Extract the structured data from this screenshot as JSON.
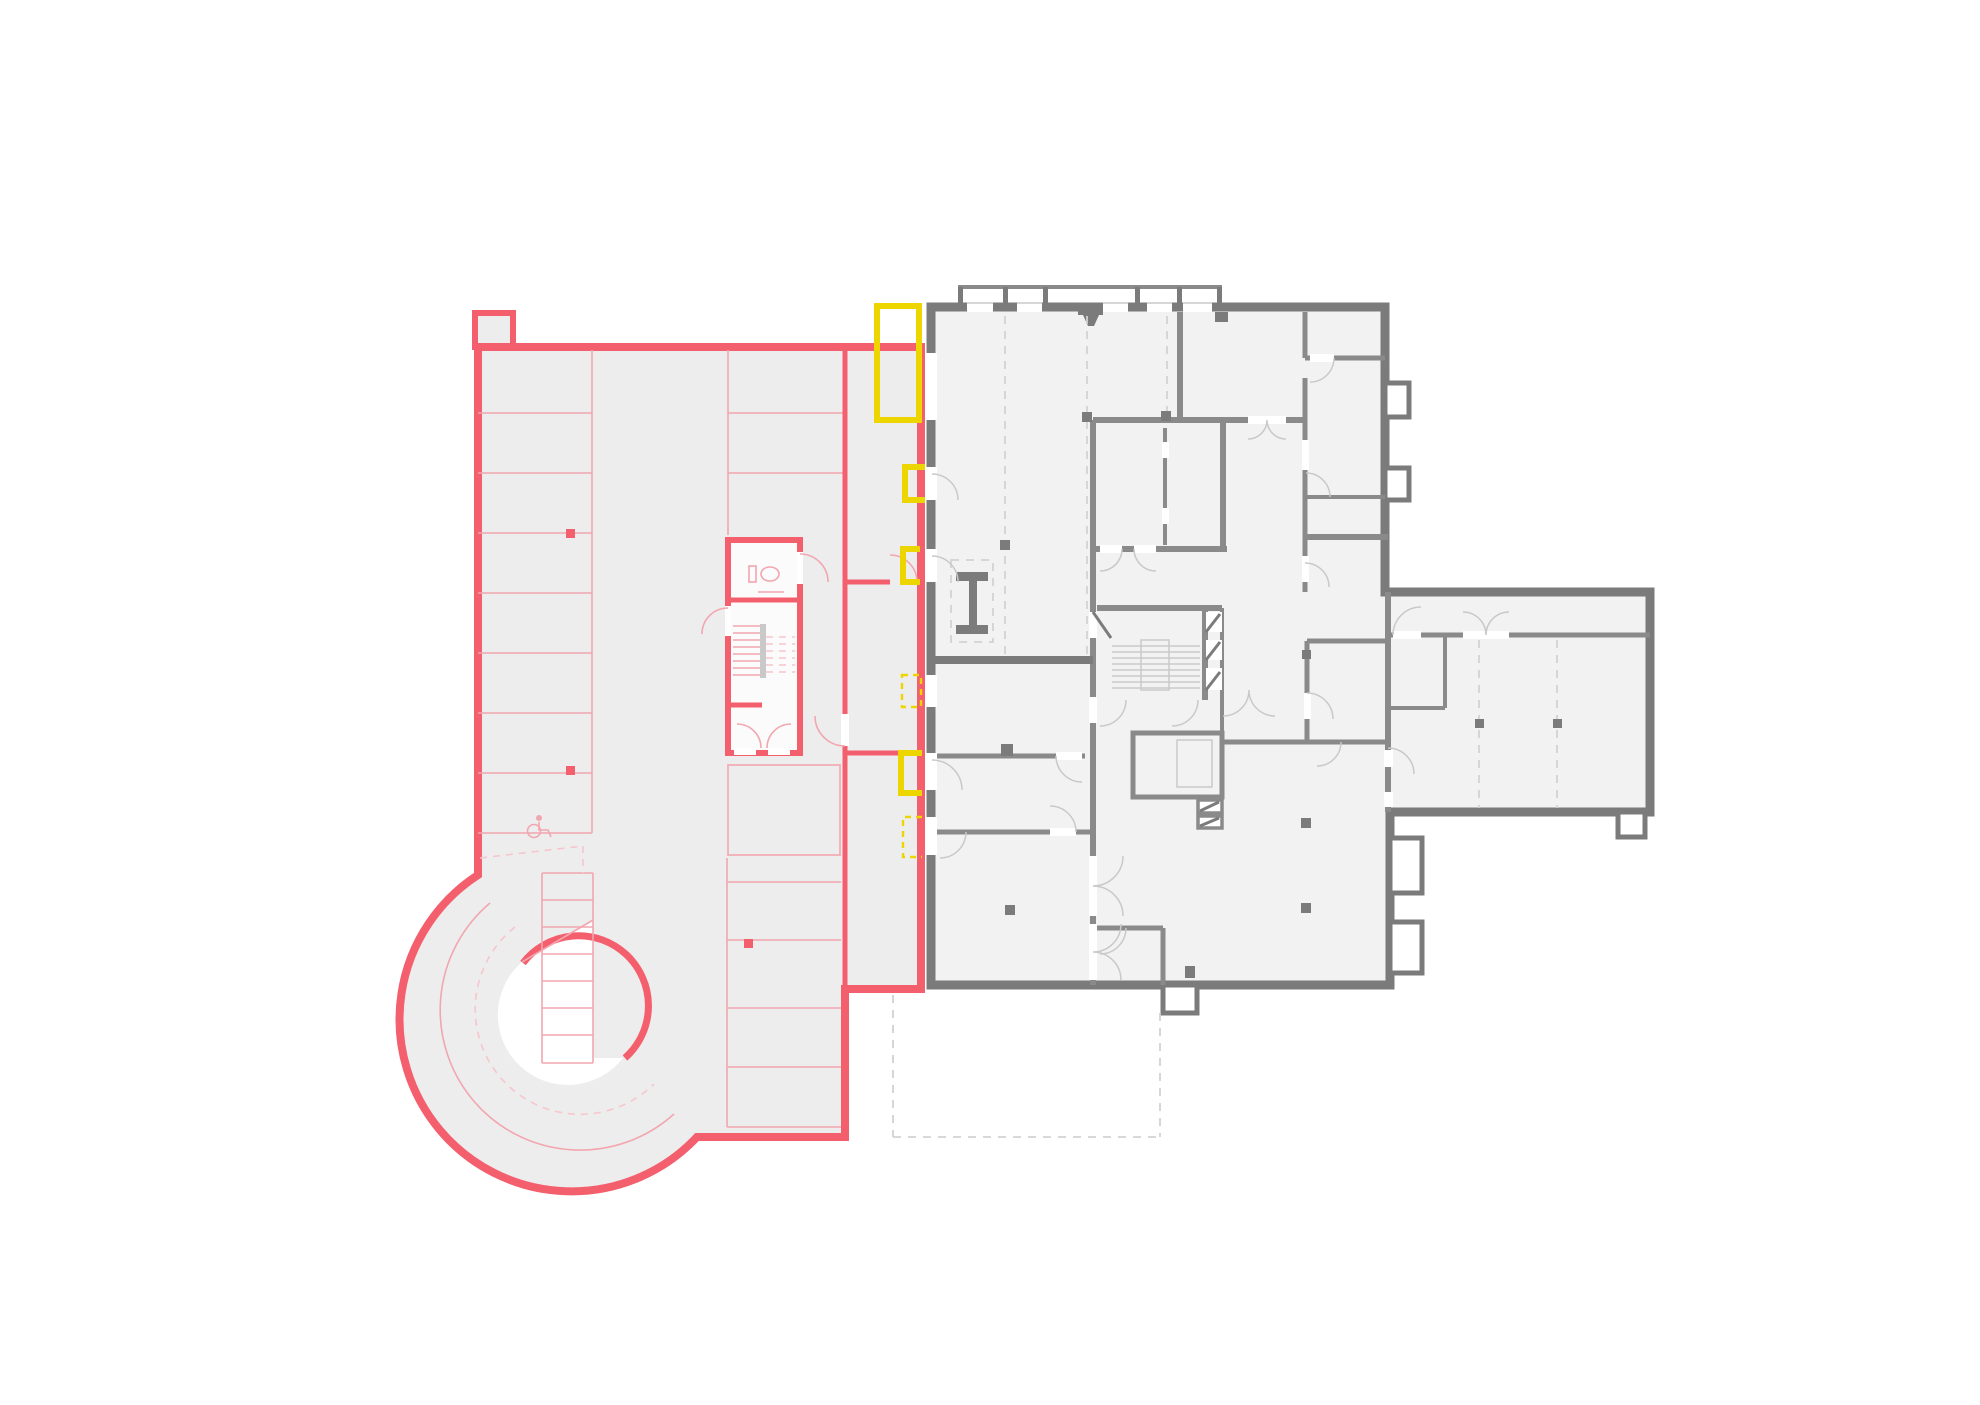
{
  "plan": {
    "kind": "architectural-floor-plan",
    "background": "#ffffff",
    "zones": {
      "parking_garage": {
        "label": "parking-garage-highlight",
        "features": [
          "parking-stalls",
          "spiral-ramp",
          "stair-wc-core",
          "accessible-parking",
          "column-markers",
          "drive-lane-dashed"
        ]
      },
      "existing_building": {
        "label": "existing-building-plan",
        "features": [
          "entrance-canopy",
          "stair-core",
          "elevator",
          "steel-column",
          "east-wing",
          "door-swings",
          "grid-dashed-lines"
        ]
      },
      "door_highlights": {
        "label": "door-opening-highlights",
        "count": 6,
        "styles": [
          "solid",
          "solid",
          "solid",
          "dashed",
          "solid",
          "dashed"
        ]
      }
    },
    "colors": {
      "bg": "#ffffff",
      "pink": "#F45F6E",
      "pinkline": "#F2A6AF",
      "pinkpale": "#F6C6CC",
      "yellow": "#EDD500",
      "walldark": "#7B7B7B",
      "wallmid": "#8A8A8A",
      "line": "#C9C9C9",
      "dash": "#D2D2D2",
      "garage": "#EDEDED",
      "room": "#F2F2F2",
      "core": "#FBFBFB"
    }
  }
}
